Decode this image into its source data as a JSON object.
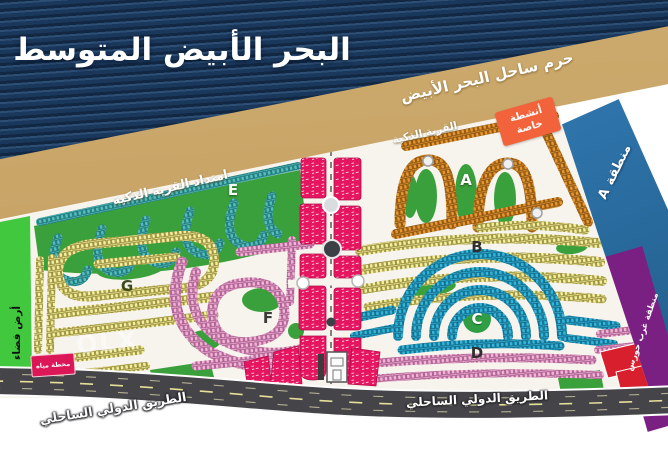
{
  "title": "البحر الأبيض المتوسط",
  "coastal_band": {
    "label": "حرم ساحل البحر الأبيض",
    "color": "#c7a164"
  },
  "sea_color": "#1c3c60",
  "strips": {
    "zone_a": {
      "label": "منطقة A",
      "color": "#2b6ea6"
    },
    "west": {
      "label": "منطقة غرب حورس",
      "color": "#7a2082"
    }
  },
  "map_labels": {
    "smart_village": "القرية الذكية",
    "smart_village_extension": "امتداد القرية الذكية",
    "vacant_land": "أرض فضاء"
  },
  "badges": {
    "special_activities": {
      "line1": "أنشطة",
      "line2": "خاصة",
      "color": "#f2633c"
    },
    "water_station": {
      "label": "محطة مياه",
      "color": "#dc1758"
    }
  },
  "road": {
    "label_left": "الطريق الدولي الساحلي",
    "label_right": "الطريق الدولي الساحلي",
    "color": "#454549"
  },
  "zone_letters": {
    "a": "A",
    "b": "B",
    "c": "C",
    "d": "D",
    "e": "E",
    "f": "F",
    "g": "G"
  },
  "zone_colors": {
    "a_orange": "#e8962e",
    "b_yellow": "#f2efa0",
    "c_cyan": "#33b6dd",
    "d_pink": "#f0b4d4",
    "e_teal": "#52bfbf",
    "f_pink": "#f0b4d4",
    "g_yellow": "#f2efa0",
    "services_magenta": "#e5155f",
    "green_areas": "#3aa03c",
    "red_blocks": "#d81f2e",
    "left_strip_green": "#41c83e"
  },
  "watermark": "OLX"
}
